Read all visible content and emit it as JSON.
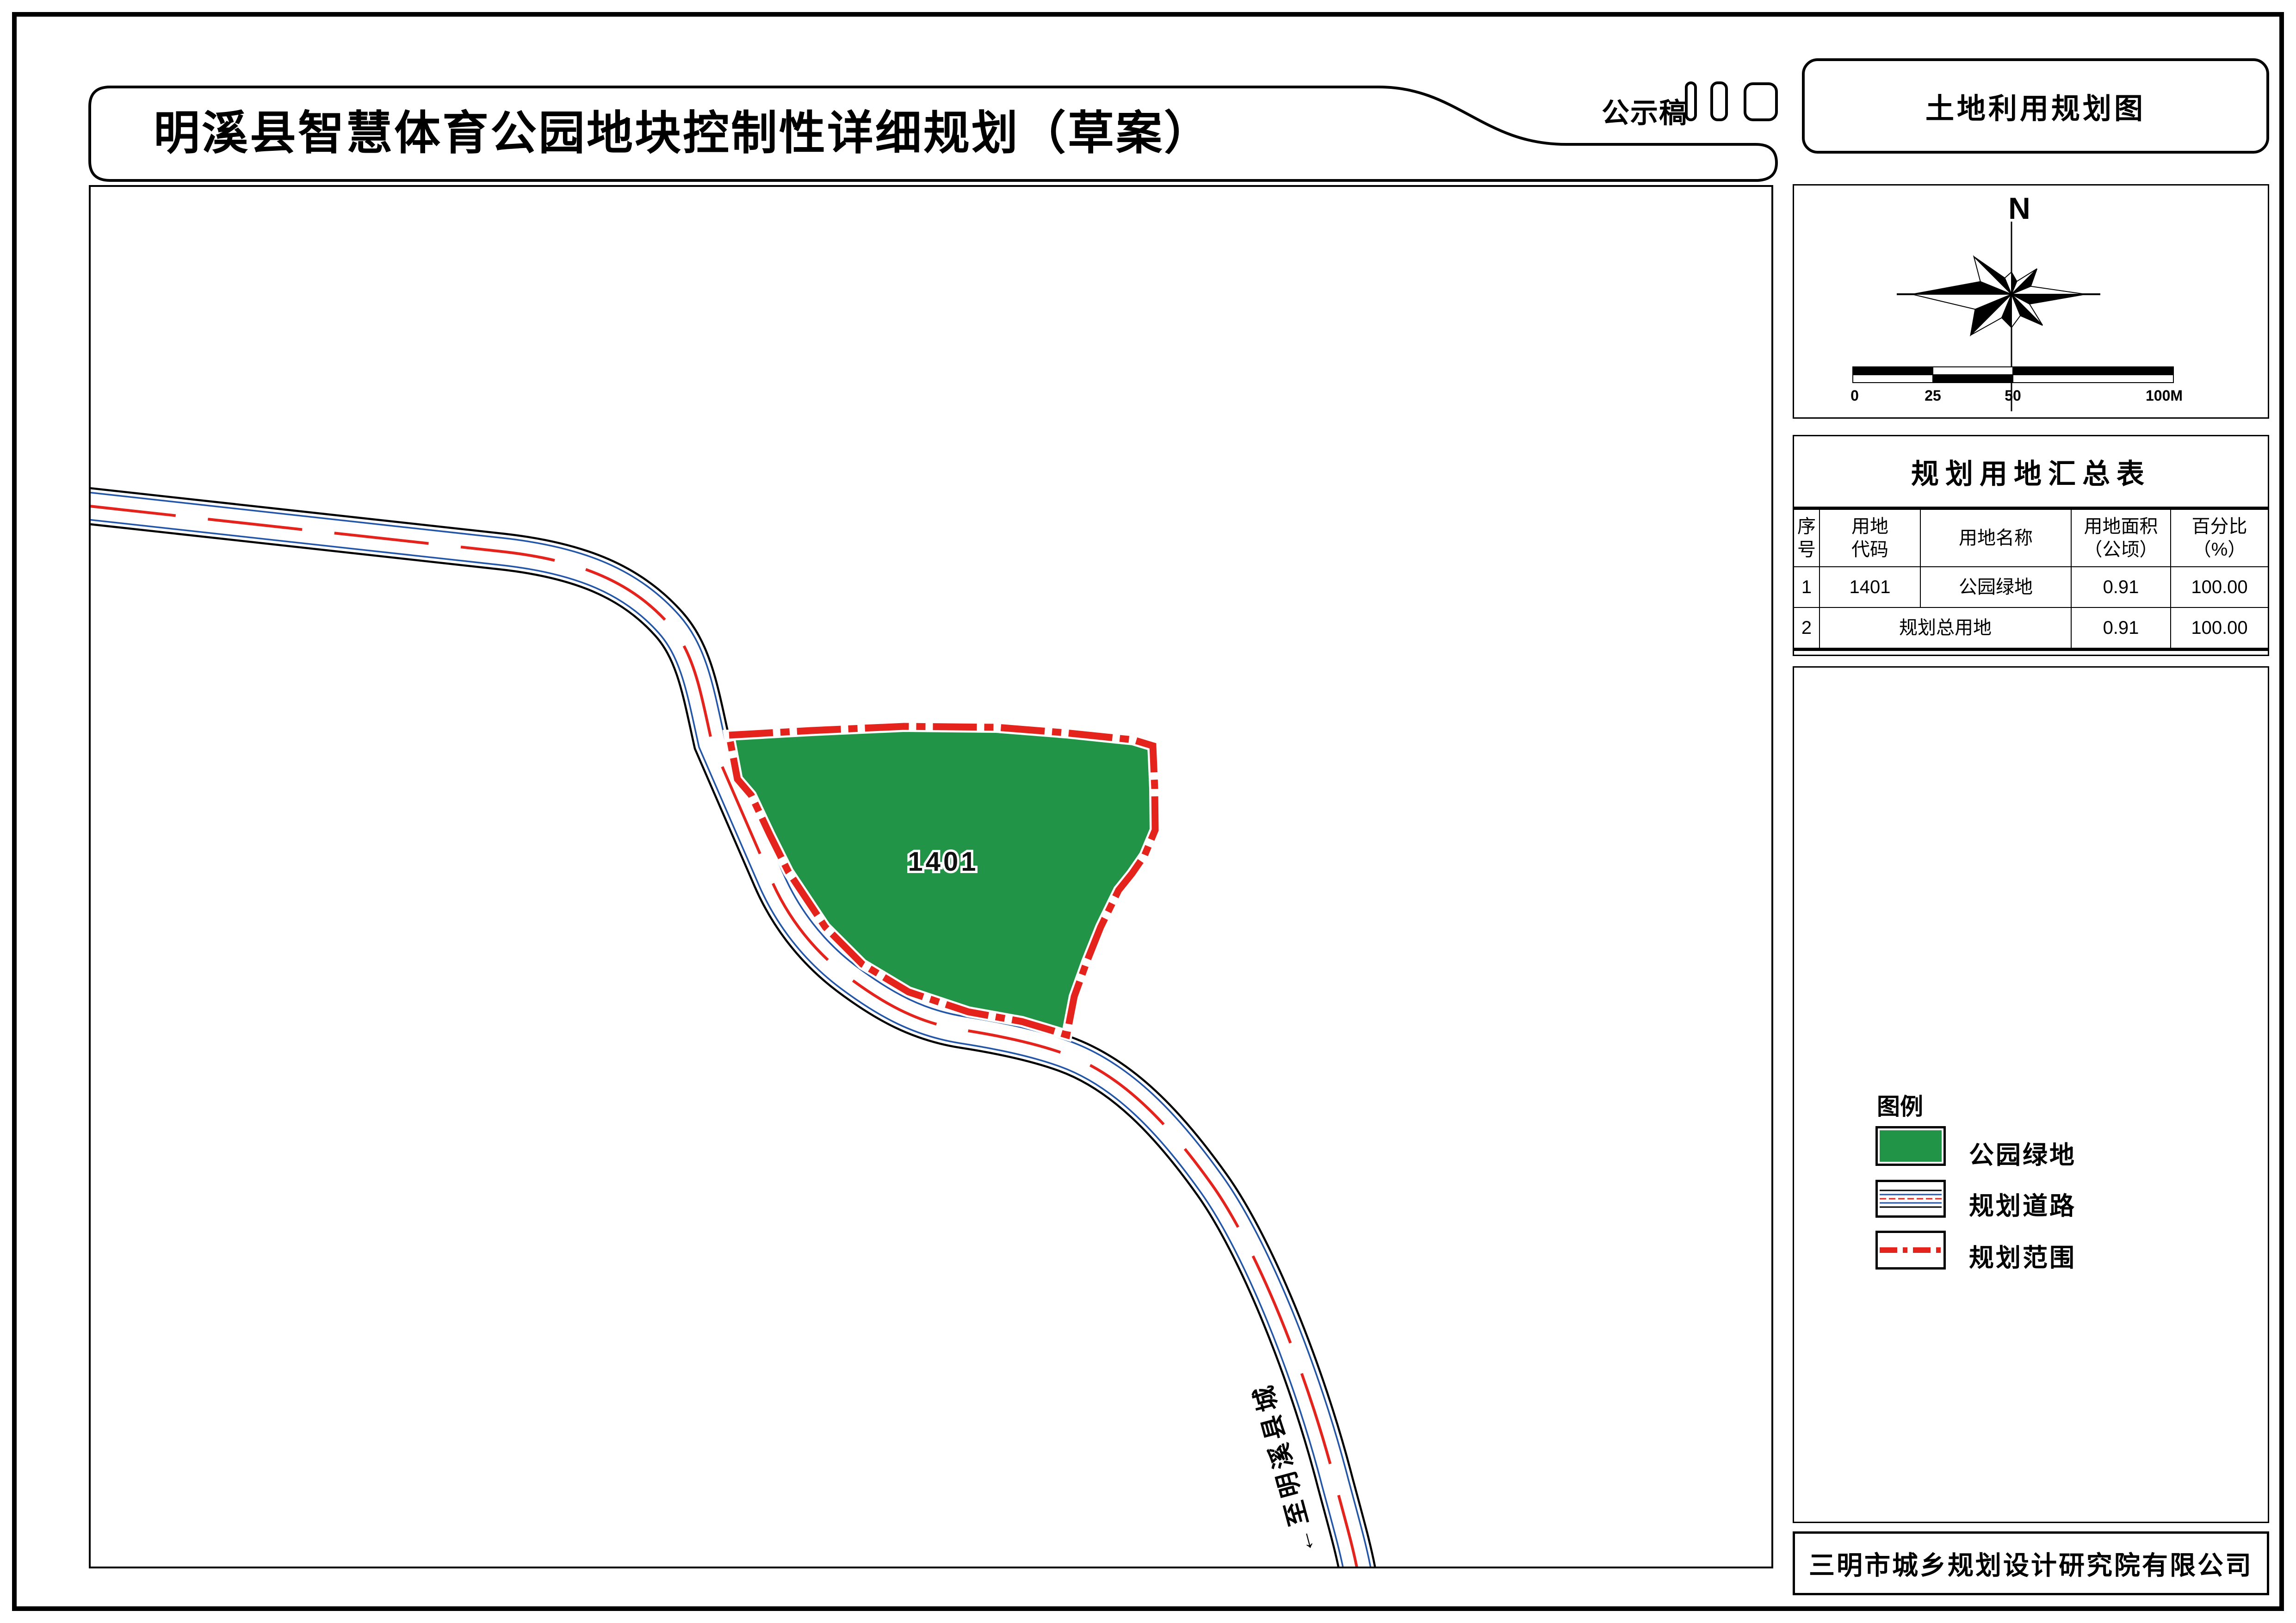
{
  "title_bar": {
    "title": "明溪县智慧体育公园地块控制性详细规划（草案）",
    "stamp": "公示稿"
  },
  "right_panel": {
    "map_title": "土地利用规划图",
    "compass": {
      "north_label": "N"
    },
    "scale_bar": {
      "ticks": [
        "0",
        "25",
        "50",
        "100M"
      ]
    },
    "summary_table": {
      "title": "规划用地汇总表",
      "headers": [
        "序\n号",
        "用地\n代码",
        "用地名称",
        "用地面积\n（公顷）",
        "百分比\n（%）"
      ],
      "rows": [
        {
          "no": "1",
          "code": "1401",
          "name": "公园绿地",
          "area": "0.91",
          "percent": "100.00"
        },
        {
          "no": "2",
          "name": "规划总用地",
          "area": "0.91",
          "percent": "100.00"
        }
      ]
    },
    "legend": {
      "title": "图例",
      "items": [
        {
          "label": "公园绿地",
          "type": "park-green"
        },
        {
          "label": "规划道路",
          "type": "planned-road"
        },
        {
          "label": "规划范围",
          "type": "planning-boundary"
        }
      ]
    },
    "company": "三明市城乡规划设计研究院有限公司"
  },
  "map": {
    "parcel_label": "1401",
    "road_label": "←至明溪县城"
  },
  "colors": {
    "park_green": "#229448",
    "boundary_red": "#e5231d",
    "road_blue": "#2456a8",
    "line_black": "#000000"
  }
}
